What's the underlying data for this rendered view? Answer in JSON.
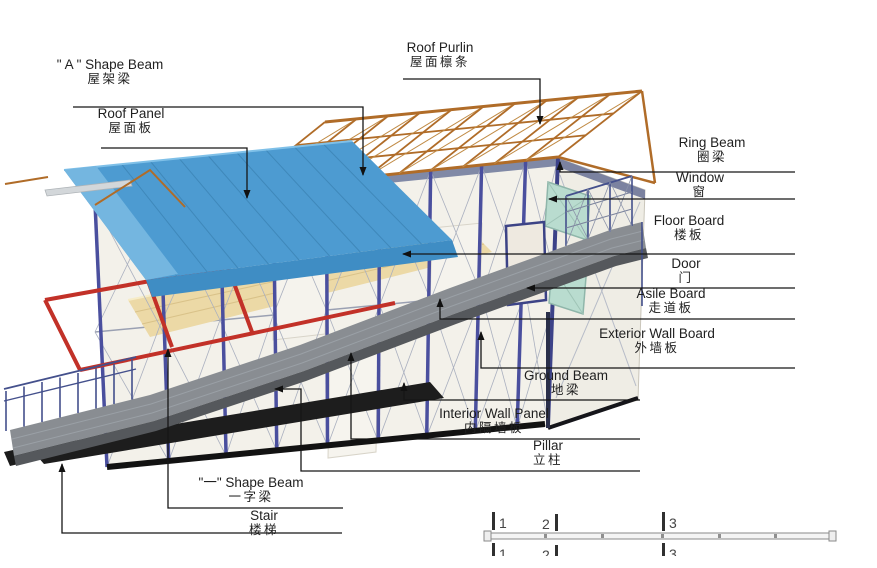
{
  "diagram_title": "Prefab house structure parts diagram",
  "labels": {
    "roof_purlin": {
      "en": "Roof Purlin",
      "zh": "屋面檩条"
    },
    "a_shape_beam": {
      "en": "\" A \" Shape Beam",
      "zh": "屋架梁"
    },
    "roof_panel": {
      "en": "Roof Panel",
      "zh": "屋面板"
    },
    "ring_beam": {
      "en": "Ring Beam",
      "zh": "圈梁"
    },
    "window": {
      "en": "Window",
      "zh": "窗"
    },
    "floor_board": {
      "en": "Floor Board",
      "zh": "楼板"
    },
    "door": {
      "en": "Door",
      "zh": "门"
    },
    "asile_board": {
      "en": "Asile Board",
      "zh": "走道板"
    },
    "exterior_wall_board": {
      "en": "Exterior Wall Board",
      "zh": "外墙板"
    },
    "ground_beam": {
      "en": "Ground Beam",
      "zh": "地梁"
    },
    "interior_wall_panel": {
      "en": "Interior Wall Panel",
      "zh": "内隔墙板"
    },
    "pillar": {
      "en": "Pillar",
      "zh": "立柱"
    },
    "one_shape_beam": {
      "en": "\"一\" Shape Beam",
      "zh": "一字梁"
    },
    "stair": {
      "en": "Stair",
      "zh": "楼梯"
    }
  },
  "scale_bar": {
    "ticks": [
      "1",
      "2",
      "3"
    ]
  },
  "colors": {
    "roof_panel_blue": "#4d9bd1",
    "roof_fascia_blue": "#3f8dc4",
    "truss_brown": "#b06c28",
    "pillar_violet": "#4a4f9e",
    "red_beam": "#c23128",
    "walkway_gray": "#898d92",
    "ground_beam_black": "#121212",
    "floor_tan": "#ecd9a6",
    "window_glass_teal": "#b9dccf",
    "wall_white": "#f3f1ea",
    "leader_line": "#161616"
  }
}
